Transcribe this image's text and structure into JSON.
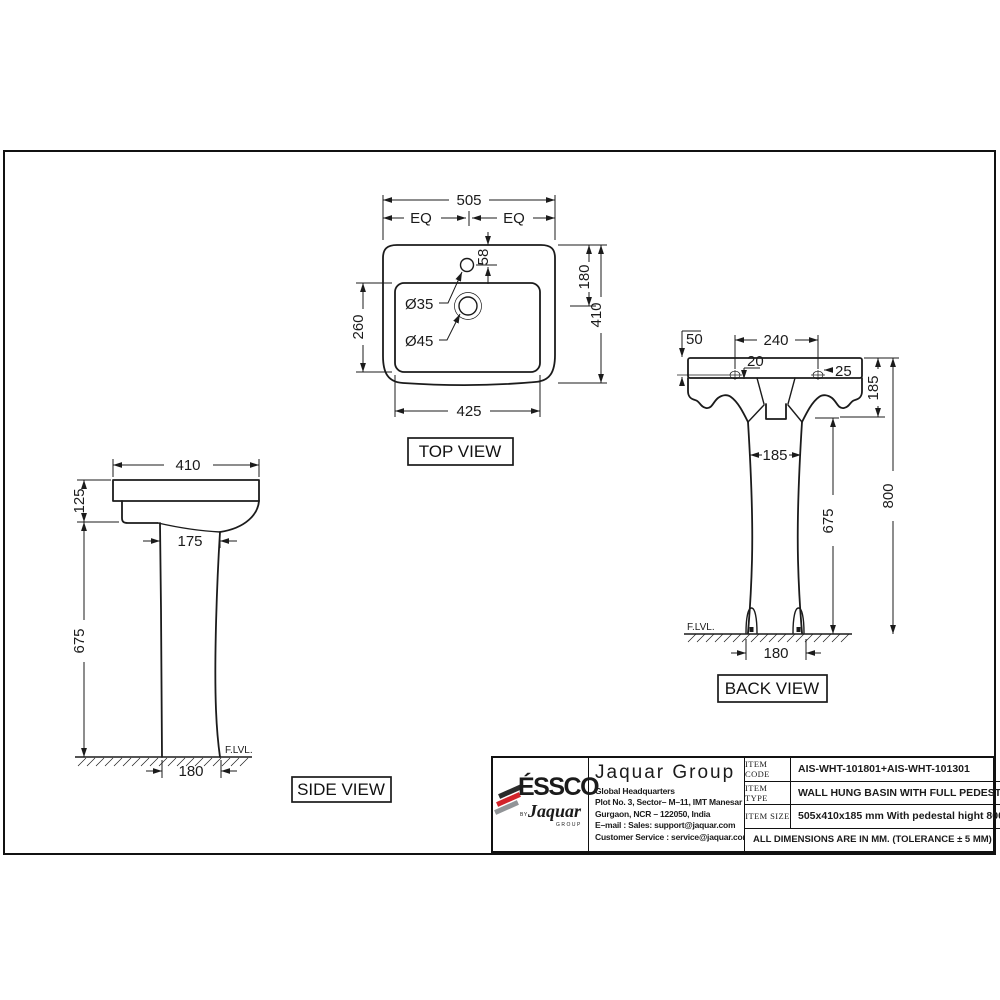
{
  "drawing": {
    "views": {
      "top": {
        "label": "TOP VIEW",
        "dim_overall_width": "505",
        "dim_eq_left": "EQ",
        "dim_eq_right": "EQ",
        "dim_faucet_from_edge": "58",
        "dim_edge_to_drain": "180",
        "dim_overall_depth": "410",
        "dim_inner_depth": "260",
        "dim_inner_width": "425",
        "callout_faucet_hole": "Ø35",
        "callout_drain_hole": "Ø45"
      },
      "side": {
        "label": "SIDE VIEW",
        "dim_overall_width": "410",
        "dim_basin_height": "125",
        "dim_pedestal_top_width": "175",
        "dim_pedestal_height": "675",
        "dim_base_width": "180",
        "floor_level": "F.LVL."
      },
      "back": {
        "label": "BACK VIEW",
        "dim_hole_from_top": "50",
        "dim_hole_spacing": "240",
        "dim_offset_small": "20",
        "dim_hole_offset": "25",
        "dim_basin_height": "185",
        "dim_pedestal_width": "185",
        "dim_pedestal_height": "675",
        "dim_overall_height": "800",
        "dim_base_width": "180",
        "floor_level": "F.LVL."
      }
    }
  },
  "title_block": {
    "logo": {
      "brand": "ÉSSCO",
      "by": "BY",
      "script": "Jaquar",
      "group": "GROUP"
    },
    "company": "Jaquar Group",
    "address_lines": [
      "Global Headquarters",
      "Plot No. 3, Sector– M–11, IMT Manesar",
      "Gurgaon, NCR – 122050, India",
      "E–mail : Sales: support@jaquar.com",
      "Customer Service : service@jaquar.com"
    ],
    "rows": [
      {
        "label": "ITEM CODE",
        "value": "AIS-WHT-101801+AIS-WHT-101301"
      },
      {
        "label": "ITEM TYPE",
        "value": "WALL HUNG BASIN WITH FULL PEDESTAL"
      },
      {
        "label": "ITEM SIZE",
        "value": "505x410x185 mm With pedestal hight 800 mm"
      }
    ],
    "note": "ALL DIMENSIONS ARE IN MM. (TOLERANCE ± 5 MM)"
  },
  "colors": {
    "line": "#1b1b1b",
    "logo_red": "#d2232a",
    "logo_gray": "#919497",
    "logo_dark": "#2b2b2b"
  }
}
